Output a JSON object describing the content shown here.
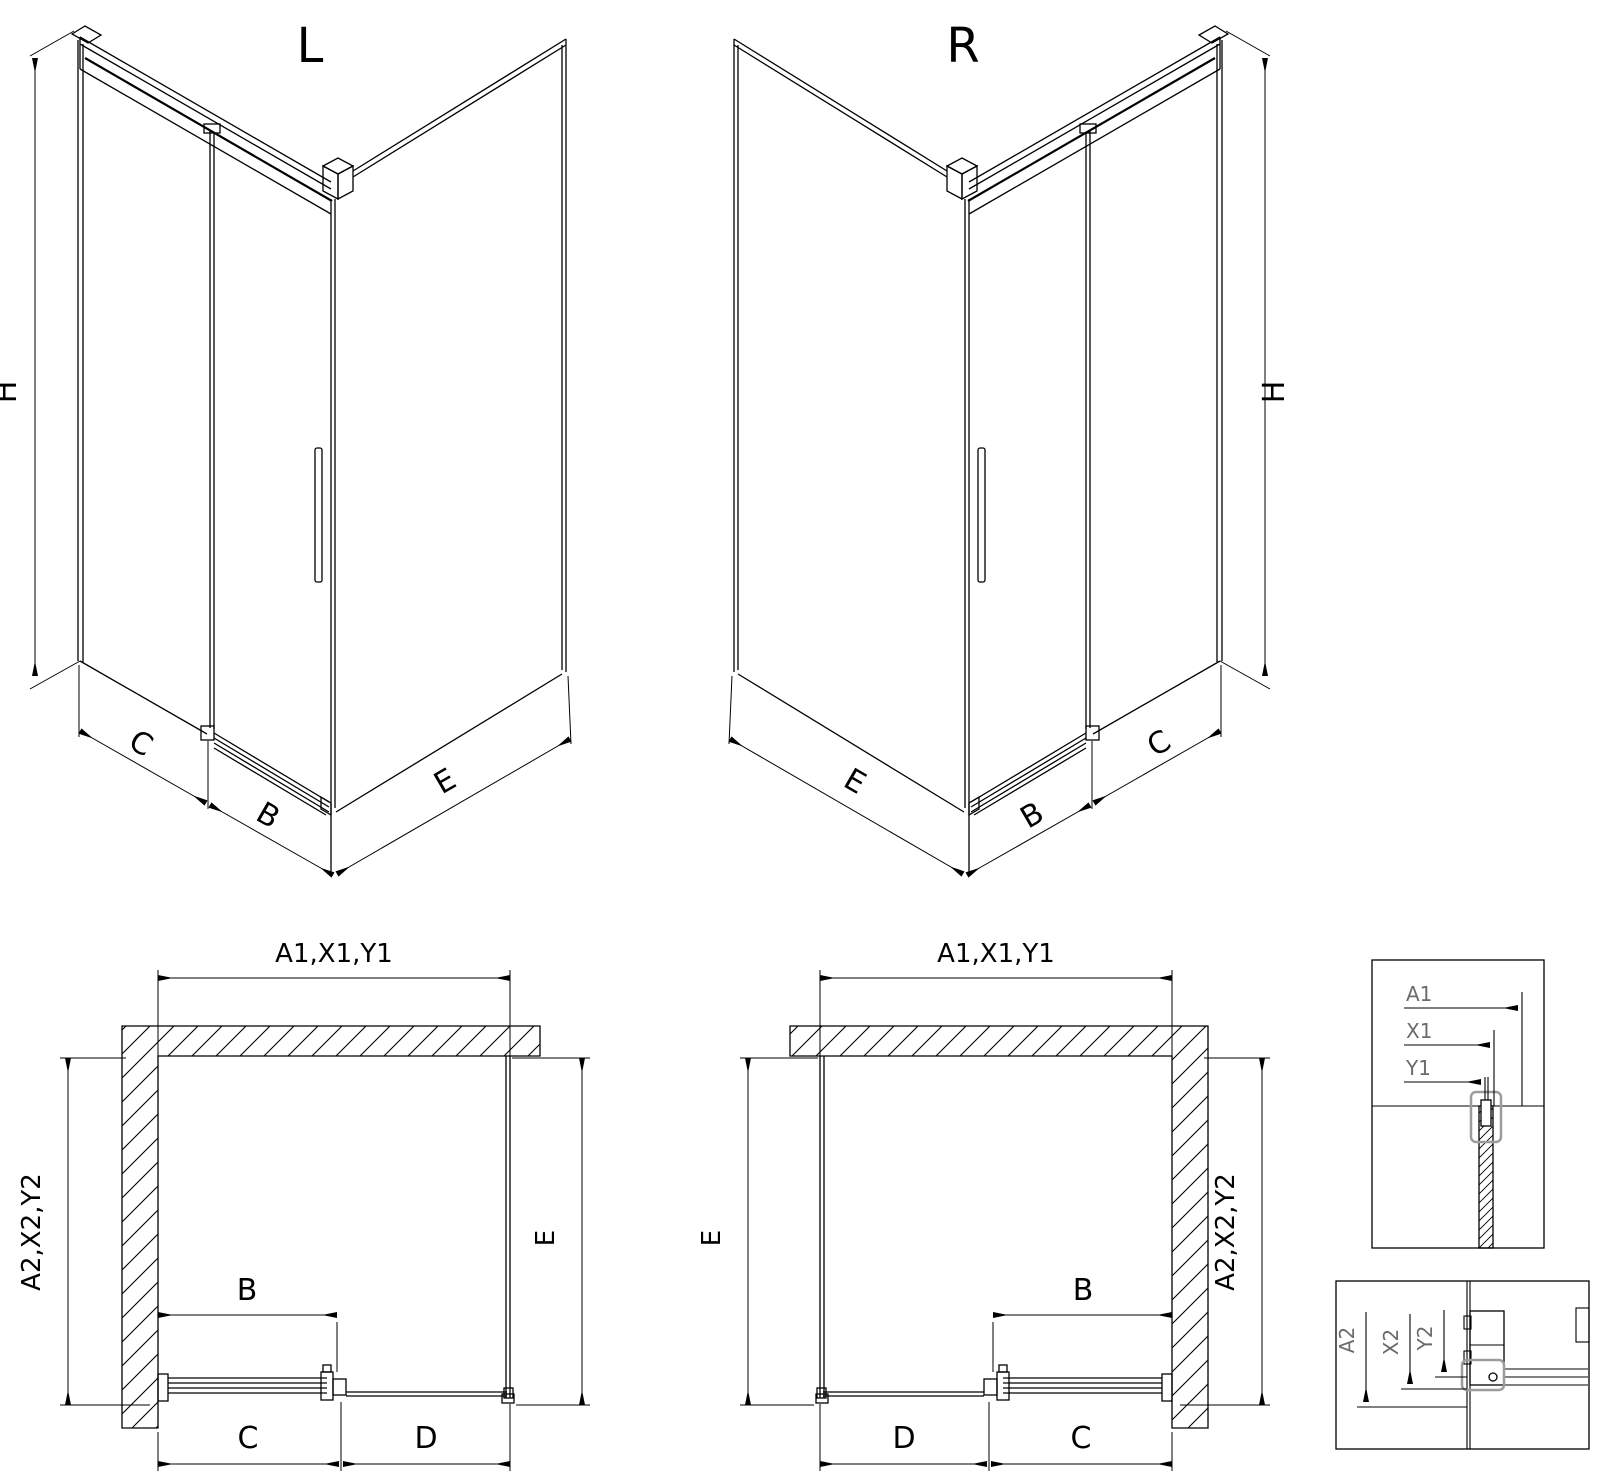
{
  "drawing": {
    "background": "#ffffff",
    "line_color": "#000000",
    "muted_color": "#6b6b6b",
    "highlight_color": "#9c9c9c"
  },
  "iso_left": {
    "title": "L",
    "dim_height": "H",
    "dim_side_panel": "C",
    "dim_door": "B",
    "dim_return_panel": "E"
  },
  "iso_right": {
    "title": "R",
    "dim_height": "H",
    "dim_side_panel": "C",
    "dim_door": "B",
    "dim_return_panel": "E"
  },
  "plan_left": {
    "dim_top": "A1,X1,Y1",
    "dim_left": "A2,X2,Y2",
    "dim_right": "E",
    "dim_door": "B",
    "dim_bottom_left": "C",
    "dim_bottom_right": "D"
  },
  "plan_right": {
    "dim_top": "A1,X1,Y1",
    "dim_left": "E",
    "dim_right": "A2,X2,Y2",
    "dim_door": "B",
    "dim_bottom_left": "D",
    "dim_bottom_right": "C"
  },
  "detail_top": {
    "a1": "A1",
    "x1": "X1",
    "y1": "Y1"
  },
  "detail_bottom": {
    "a2": "A2",
    "x2": "X2",
    "y2": "Y2"
  }
}
